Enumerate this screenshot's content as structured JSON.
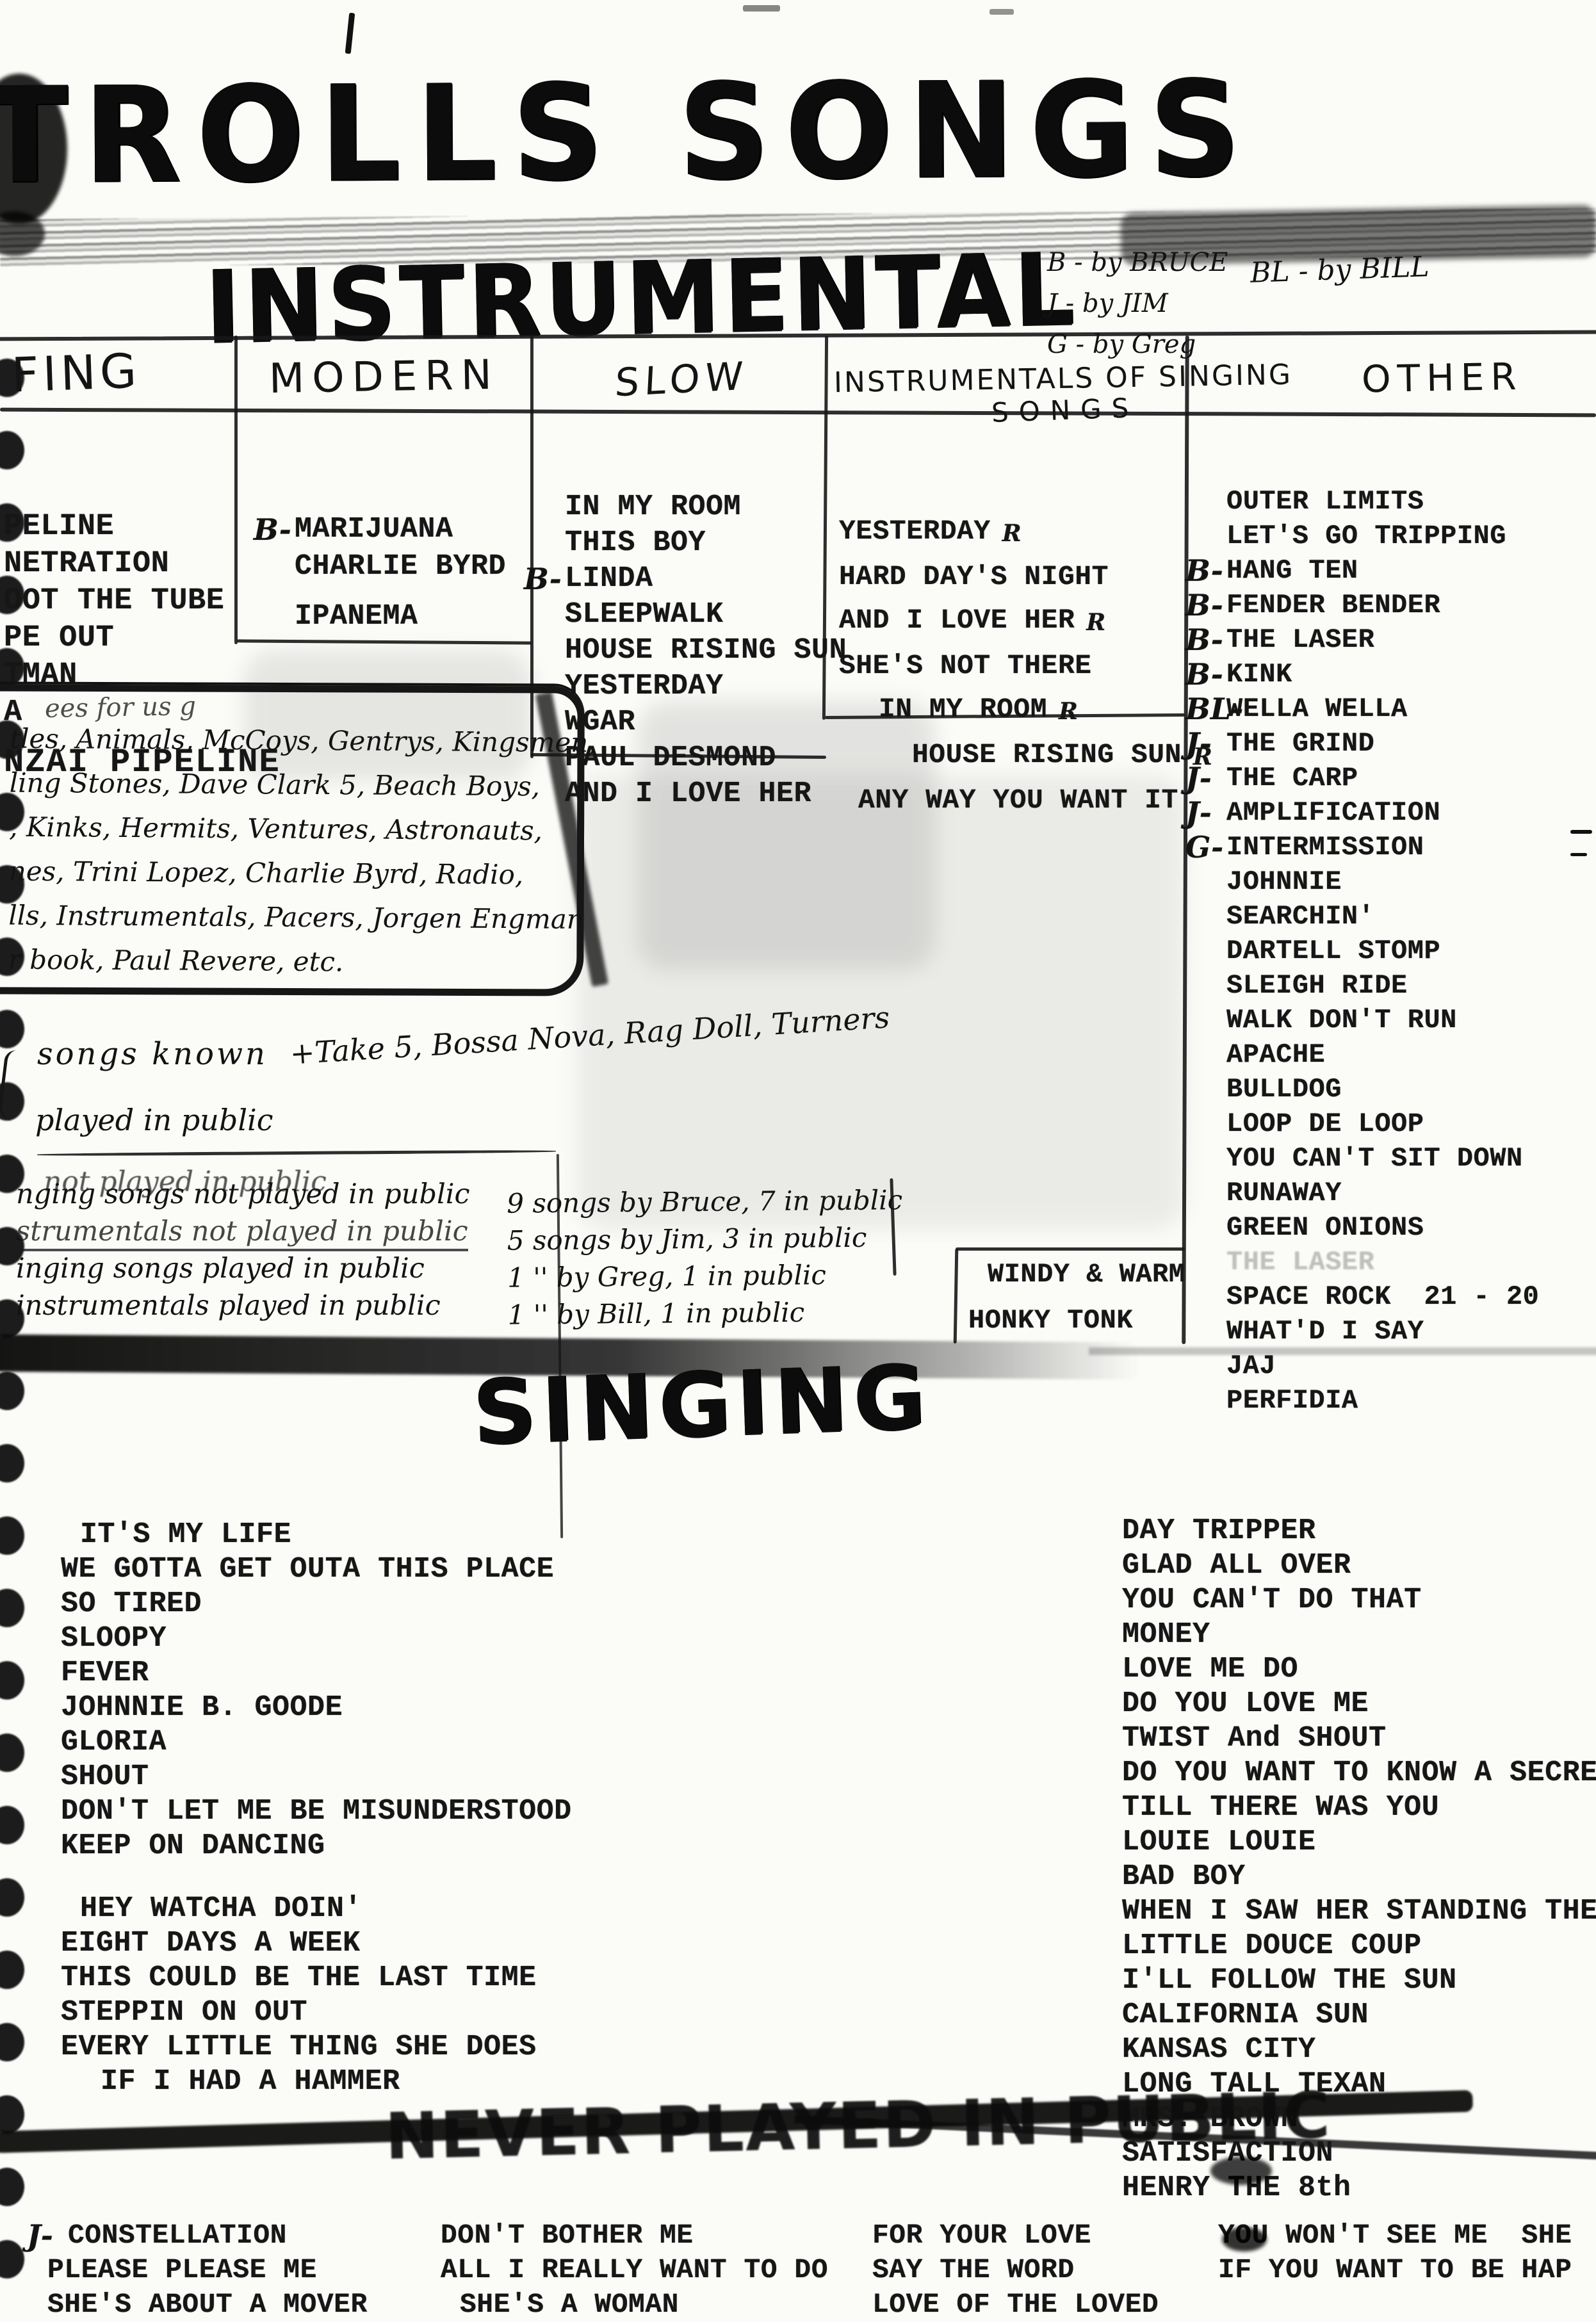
{
  "title": "TROLLS SONGS",
  "instrumental": {
    "heading": "INSTRUMENTAL",
    "legend": [
      "B - by BRUCE",
      "J - by JIM",
      "G - by Greg"
    ],
    "legend2": "BL - by BILL",
    "col_surfing": {
      "header": "FING",
      "songs": [
        "PELINE",
        "NETRATION",
        "OOT THE TUBE",
        "PE OUT",
        "TMAN",
        "A",
        {
          "text": "NZAI PIPELINE",
          "cls": "big gap-sm"
        }
      ]
    },
    "col_modern": {
      "header": "MODERN",
      "songs": [
        {
          "pre": "B-",
          "text": "MARIJUANA"
        },
        "CHARLIE BYRD",
        {
          "text": "IPANEMA",
          "cls": "gap-sm"
        }
      ]
    },
    "col_slow": {
      "header": "SLOW",
      "songs": [
        "IN MY ROOM",
        "THIS BOY",
        {
          "pre": "B-",
          "text": "LINDA"
        },
        "SLEEPWALK",
        "HOUSE RISING SUN",
        "YESTERDAY",
        "WGAR",
        "PAUL DESMOND",
        "AND I LOVE HER"
      ]
    },
    "col_instr_singing": {
      "header_line1": "INSTRUMENTALS OF SINGING",
      "header_line2": "SONGS",
      "songs": [
        {
          "text": "YESTERDAY",
          "note": "R"
        },
        "HARD DAY'S NIGHT",
        {
          "text": "AND I LOVE HER",
          "note": "R"
        },
        "SHE'S NOT THERE",
        {
          "text": "IN MY ROOM",
          "note": "R",
          "cls": "ind1"
        },
        {
          "text": "HOUSE RISING SUN",
          "note": "R",
          "cls": "ind2"
        },
        {
          "text": "ANY WAY YOU WANT IT",
          "cls": "indsm"
        }
      ]
    },
    "col_other": {
      "header": "OTHER",
      "songs": [
        "OUTER LIMITS",
        "LET'S GO TRIPPING",
        {
          "pre": "B-",
          "text": "HANG TEN"
        },
        {
          "pre": "B-",
          "text": "FENDER BENDER"
        },
        {
          "pre": "B-",
          "text": "THE LASER"
        },
        {
          "pre": "B-",
          "text": "KINK"
        },
        {
          "pre": "BL-",
          "text": "WELLA WELLA"
        },
        {
          "pre": "J-",
          "text": "THE GRIND"
        },
        {
          "pre": "J-",
          "text": "THE CARP"
        },
        {
          "pre": "J-",
          "text": "AMPLIFICATION"
        },
        {
          "pre": "G-",
          "text": "INTERMISSION"
        },
        "JOHNNIE",
        "SEARCHIN'",
        "DARTELL STOMP",
        "SLEIGH RIDE",
        "WALK DON'T RUN",
        "APACHE",
        "BULLDOG",
        "LOOP DE LOOP",
        "YOU CAN'T SIT DOWN",
        "RUNAWAY",
        "GREEN ONIONS",
        {
          "text": "THE LASER",
          "cls": "faded"
        },
        "SPACE ROCK  21 - 20",
        "WHAT'D I SAY",
        "JAJ",
        "PERFIDIA"
      ]
    },
    "corner_song1": "WINDY & WARM",
    "corner_song2": "HONKY TONK"
  },
  "notes": {
    "groups_caption": "ees for us g",
    "groups": [
      "tles, Animals, McCoys, Gentrys, Kingsmen,",
      "ling Stones, Dave Clark 5, Beach Boys,",
      ", Kinks, Hermits, Ventures, Astronauts,",
      "nes, Trini Lopez, Charlie Byrd, Radio,",
      "lls, Instrumentals, Pacers, Jorgen Engman",
      "r book, Paul Revere, etc."
    ],
    "songs_known": "songs known",
    "songs_known_extra": "+Take 5, Bossa Nova, Rag Doll, Turners",
    "played": "played in public",
    "not_played": "not played in public",
    "legend_lines": [
      "nging songs not played in public",
      {
        "text": "strumentals not played in public",
        "cls": "ul faint"
      },
      "inging songs played in public",
      "instrumentals played in public"
    ],
    "counts": [
      "9 songs by Bruce, 7 in public",
      "5 songs by Jim, 3 in public",
      "1  ''   by Greg, 1 in public",
      "1  ''   by Bill, 1 in public"
    ]
  },
  "singing": {
    "heading": "SINGING",
    "left": [
      {
        "text": "IT'S MY LIFE",
        "cls": "indsm"
      },
      "WE GOTTA GET OUTA THIS PLACE",
      "SO TIRED",
      "SLOOPY",
      "FEVER",
      "JOHNNIE B. GOODE",
      "GLORIA",
      "SHOUT",
      "DON'T LET ME BE MISUNDERSTOOD",
      "KEEP ON DANCING",
      {
        "text": "HEY WATCHA DOIN'",
        "cls": "indsm gap"
      },
      "EIGHT DAYS A WEEK",
      "THIS COULD BE THE LAST TIME",
      "STEPPIN ON OUT",
      "EVERY LITTLE THING SHE DOES",
      {
        "text": "IF I HAD A HAMMER",
        "cls": "ind1"
      }
    ],
    "right": [
      "DAY TRIPPER",
      "GLAD ALL OVER",
      "YOU CAN'T DO THAT",
      "MONEY",
      "LOVE ME DO",
      "DO YOU LOVE ME",
      "TWIST And SHOUT",
      "DO YOU WANT TO KNOW A SECRE",
      "TILL THERE WAS YOU",
      "LOUIE LOUIE",
      "BAD BOY",
      "WHEN I SAW HER STANDING THE",
      "LITTLE DOUCE COUP",
      "I'LL FOLLOW THE SUN",
      "CALIFORNIA SUN",
      "KANSAS CITY",
      "LONG TALL TEXAN",
      "MRS. BROWN",
      "SATISFACTION",
      "HENRY THE 8th"
    ]
  },
  "bottom": {
    "heading": "NEVER PLAYED IN PUBLIC",
    "col1": [
      {
        "pre": "J-",
        "text": "CONSTELLATION"
      },
      {
        "text": "PLEASE PLEASE ME",
        "cls": "indsm"
      },
      {
        "text": "SHE'S ABOUT A MOVER",
        "cls": "indsm"
      }
    ],
    "col2": [
      "DON'T BOTHER ME",
      "ALL I REALLY WANT TO DO",
      {
        "text": "SHE'S A WOMAN",
        "cls": "indsm"
      }
    ],
    "col3": [
      "FOR YOUR LOVE",
      "SAY THE WORD",
      "LOVE OF THE LOVED"
    ],
    "col4": [
      "YOU WON'T SEE ME  SHE",
      "IF YOU WANT TO BE HAP"
    ]
  }
}
